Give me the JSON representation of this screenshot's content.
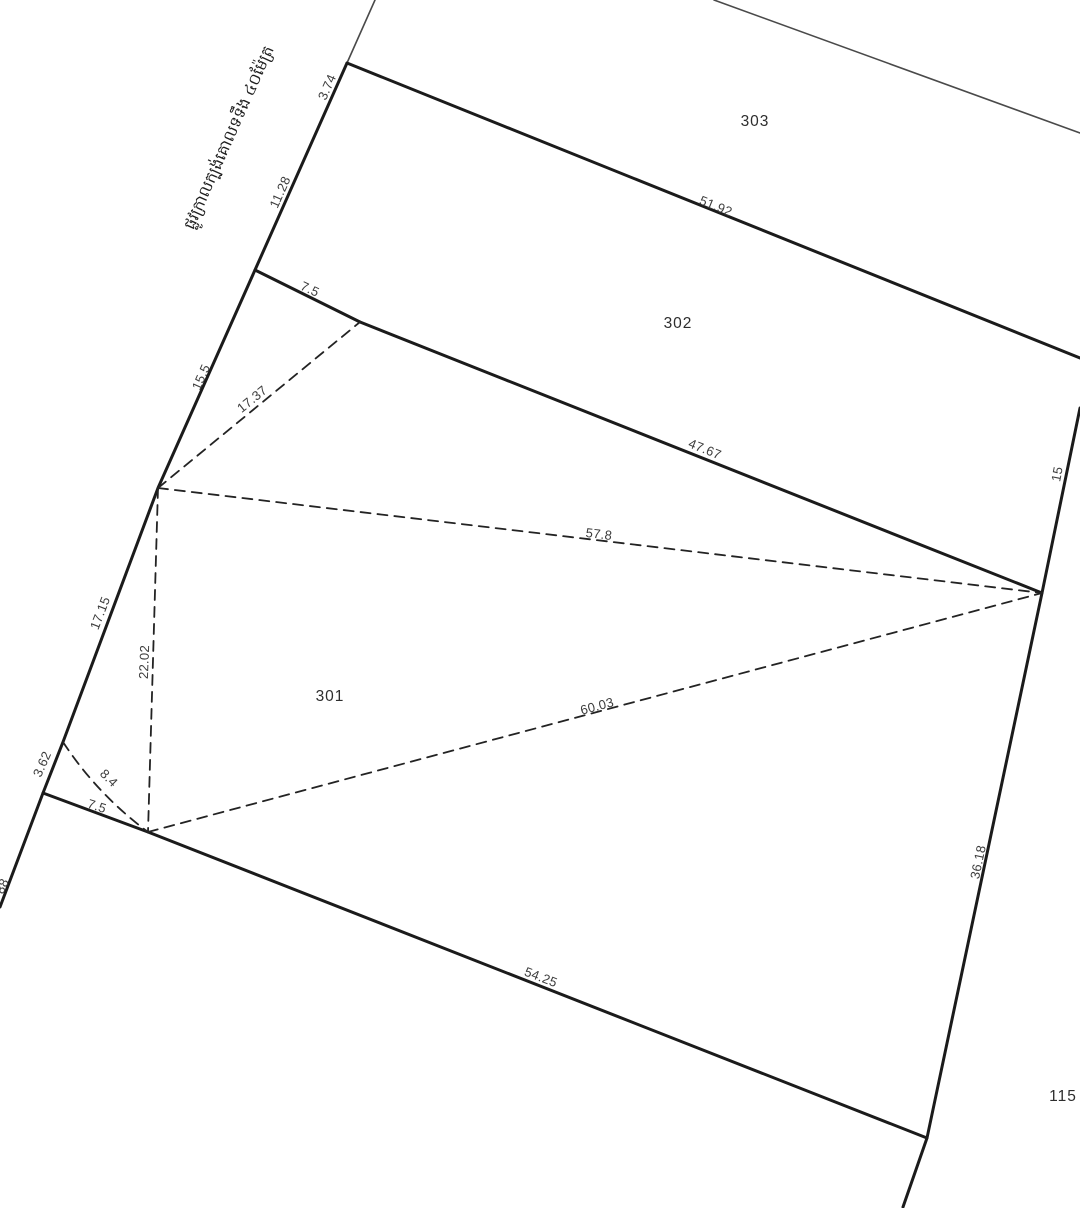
{
  "canvas": {
    "width": 1080,
    "height": 1208,
    "background": "#ffffff",
    "ink": "#1b1b1b",
    "thin_ink": "#4a4a4a",
    "dash_ink": "#232323"
  },
  "road_label": {
    "text": "ផ្លូវក្រាលក្បង់គោលទទឹង ៤០ម៉ែត្រ",
    "x": 230,
    "y": 138,
    "rotation": -66
  },
  "parcels": [
    {
      "id": "303",
      "x": 755,
      "y": 122
    },
    {
      "id": "302",
      "x": 678,
      "y": 324
    },
    {
      "id": "301",
      "x": 330,
      "y": 697
    },
    {
      "id": "115",
      "x": 1063,
      "y": 1097
    }
  ],
  "measurements": [
    {
      "text": "3.74",
      "x": 327,
      "y": 87,
      "rotation": -66
    },
    {
      "text": "11.28",
      "x": 280,
      "y": 192,
      "rotation": -66
    },
    {
      "text": "7.5",
      "x": 310,
      "y": 289,
      "rotation": 25
    },
    {
      "text": "51.92",
      "x": 716,
      "y": 206,
      "rotation": 22
    },
    {
      "text": "15.5",
      "x": 201,
      "y": 377,
      "rotation": -66
    },
    {
      "text": "17.37",
      "x": 252,
      "y": 399,
      "rotation": -39
    },
    {
      "text": "47.67",
      "x": 705,
      "y": 449,
      "rotation": 22
    },
    {
      "text": "15",
      "x": 1057,
      "y": 474,
      "rotation": -79
    },
    {
      "text": "57.8",
      "x": 599,
      "y": 534,
      "rotation": 7
    },
    {
      "text": "17.15",
      "x": 100,
      "y": 613,
      "rotation": -69
    },
    {
      "text": "22.02",
      "x": 144,
      "y": 662,
      "rotation": -88
    },
    {
      "text": "60.03",
      "x": 597,
      "y": 706,
      "rotation": -15
    },
    {
      "text": "3.62",
      "x": 42,
      "y": 764,
      "rotation": -66
    },
    {
      "text": "8.4",
      "x": 109,
      "y": 778,
      "rotation": 45
    },
    {
      "text": "7.5",
      "x": 97,
      "y": 806,
      "rotation": 18
    },
    {
      "text": "36.18",
      "x": 978,
      "y": 862,
      "rotation": -78
    },
    {
      "text": "54.25",
      "x": 541,
      "y": 977,
      "rotation": 21
    },
    {
      "text": "88",
      "x": 2,
      "y": 886,
      "rotation": -66
    }
  ],
  "geometry": {
    "solid_lines": [
      {
        "name": "road-edge-boundary",
        "points": [
          [
            347,
            63
          ],
          [
            255,
            270
          ],
          [
            158,
            488
          ],
          [
            63,
            742
          ],
          [
            43,
            793
          ],
          [
            0,
            907
          ]
        ],
        "width": 3,
        "thin": false
      },
      {
        "name": "road-edge-extension",
        "points": [
          [
            375,
            0
          ],
          [
            347,
            63
          ]
        ],
        "width": 1.6,
        "thin": true
      },
      {
        "name": "boundary-303-302",
        "points": [
          [
            347,
            63
          ],
          [
            1080,
            358
          ]
        ],
        "width": 3,
        "thin": false
      },
      {
        "name": "boundary-302-west",
        "points": [
          [
            255,
            270
          ],
          [
            360,
            322
          ]
        ],
        "width": 3,
        "thin": false
      },
      {
        "name": "boundary-302-301",
        "points": [
          [
            360,
            322
          ],
          [
            1042,
            593
          ]
        ],
        "width": 3,
        "thin": false
      },
      {
        "name": "east-boundary",
        "points": [
          [
            1080,
            408
          ],
          [
            1042,
            593
          ],
          [
            927,
            1138
          ],
          [
            903,
            1207
          ]
        ],
        "width": 3,
        "thin": false
      },
      {
        "name": "boundary-301-southwest",
        "points": [
          [
            43,
            793
          ],
          [
            148,
            832
          ]
        ],
        "width": 3,
        "thin": false
      },
      {
        "name": "boundary-301-south",
        "points": [
          [
            148,
            832
          ],
          [
            927,
            1138
          ]
        ],
        "width": 3,
        "thin": false
      },
      {
        "name": "neighbor-north-line",
        "points": [
          [
            714,
            0
          ],
          [
            1080,
            133
          ]
        ],
        "width": 1.6,
        "thin": true
      }
    ],
    "dashed_lines": [
      {
        "name": "tie-line-17-37",
        "points": [
          [
            158,
            488
          ],
          [
            360,
            322
          ]
        ]
      },
      {
        "name": "tie-line-57-8",
        "points": [
          [
            158,
            488
          ],
          [
            1042,
            593
          ]
        ]
      },
      {
        "name": "tie-line-22-02",
        "points": [
          [
            158,
            488
          ],
          [
            148,
            832
          ]
        ]
      },
      {
        "name": "tie-line-60-03",
        "points": [
          [
            148,
            832
          ],
          [
            1042,
            593
          ]
        ]
      }
    ],
    "dashed_arc": {
      "name": "tie-arc-8-4",
      "from": [
        63,
        742
      ],
      "control": [
        97,
        794
      ],
      "to": [
        148,
        832
      ]
    }
  }
}
